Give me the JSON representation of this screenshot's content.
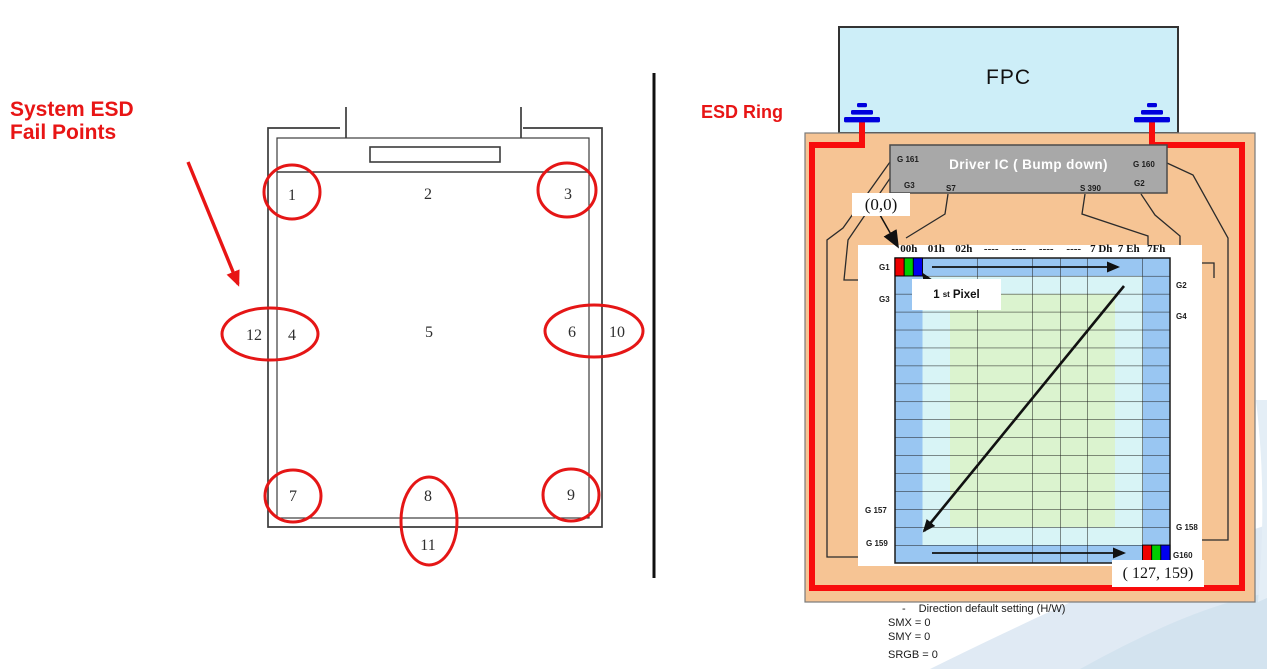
{
  "colors": {
    "accent-red": "#e81515",
    "ring-red": "#f80c0c",
    "panel-orange": "#f6c494",
    "fpc-cyan": "#cdeef8",
    "ic-gray": "#a8a8a8",
    "ground-blue": "#0000dd",
    "cell-blue": "#99c6f2",
    "cell-cyan": "#d8f4f6",
    "cell-green": "#dbf3cf"
  },
  "left": {
    "title_line1": "System ESD",
    "title_line2": "Fail Points",
    "points": [
      "1",
      "2",
      "3",
      "4",
      "5",
      "6",
      "7",
      "8",
      "9",
      "10",
      "11",
      "12"
    ]
  },
  "right": {
    "esd_ring_label": "ESD Ring",
    "fpc_label": "FPC",
    "driver_ic": {
      "title": "Driver IC ( Bump down)",
      "pin_g161": "G 161",
      "pin_g160": "G 160",
      "pin_g3": "G3",
      "pin_s7": "S7",
      "pin_s390": "S 390",
      "pin_g2": "G2"
    },
    "origin_label": "(0,0)",
    "first_pixel": {
      "num": "1",
      "sup": "st",
      "word": "Pixel"
    },
    "grid": {
      "col_headers": [
        "00h",
        "01h",
        "02h",
        "----",
        "----",
        "----",
        "----",
        "7 Dh",
        "7 Eh",
        "7Fh"
      ],
      "left_labels": [
        "G1",
        "G3",
        "G 157",
        "G 159"
      ],
      "right_labels": [
        "G2",
        "G4",
        "G 158",
        "G160"
      ]
    },
    "end_label": "( 127, 159)",
    "notes": {
      "bullet": "-",
      "title": "Direction default setting (H/W)",
      "smx": "SMX =  0",
      "smy": "SMY =  0",
      "srgb": "SRGB =  0"
    }
  }
}
